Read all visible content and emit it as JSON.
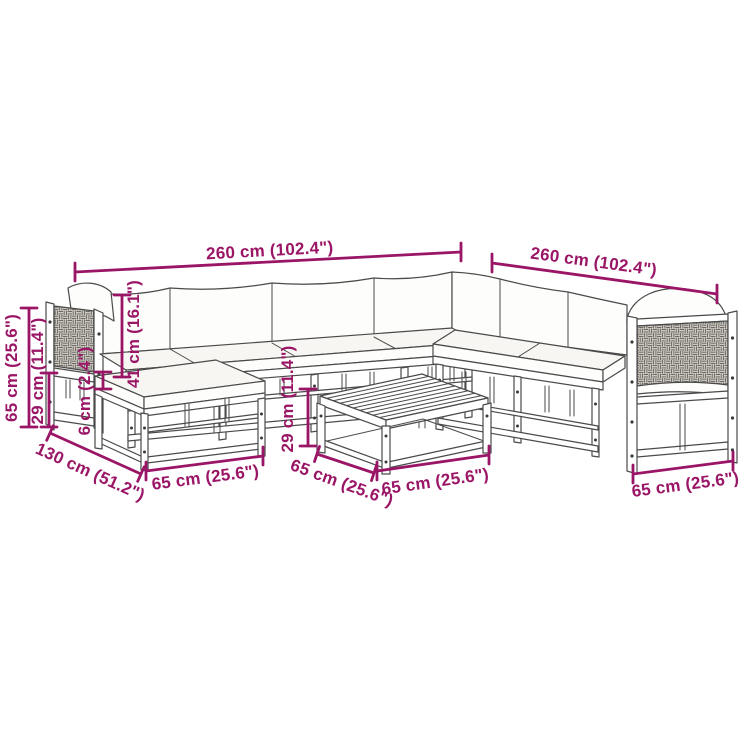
{
  "diagram": {
    "colors": {
      "dimension_accent": "#9a1566",
      "line_art": "#4a4a4a",
      "background": "#ffffff",
      "rattan_fill": "#d9d6d0",
      "rattan_weave": "#6e6a63"
    },
    "dimensions": {
      "sofa_width_back": "260 cm (102.4\")",
      "sofa_width_right": "260 cm (102.4\")",
      "total_height": "65 cm (25.6\")",
      "seat_frame_height": "29 cm (11.4\")",
      "cushion_thickness": "6 cm (2.4\")",
      "backrest_height": "41 cm (16.1\")",
      "corner_depth": "130 cm (51.2\")",
      "footstool_width": "65 cm (25.6\")",
      "table_height": "29 cm (11.4\")",
      "table_depth": "65 cm (25.6\")",
      "table_width": "65 cm (25.6\")",
      "end_section_width": "65 cm (25.6\")"
    }
  }
}
